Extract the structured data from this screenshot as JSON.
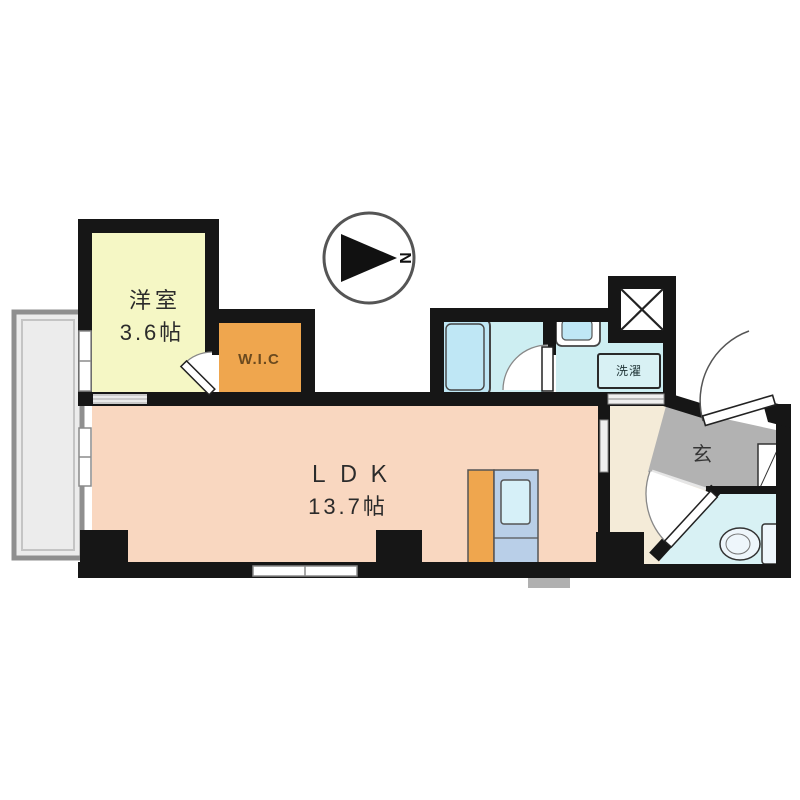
{
  "plan": {
    "type": "floor-plan",
    "compass": {
      "north_label": "N",
      "direction": "right"
    },
    "rooms": {
      "bedroom": {
        "name": "洋室",
        "size": "3.6帖"
      },
      "wic": {
        "label": "W.I.C"
      },
      "ldk": {
        "name": "ＬＤＫ",
        "size": "13.7帖"
      },
      "laundry": {
        "label": "洗濯"
      },
      "entrance": {
        "label": "玄"
      }
    }
  },
  "colors": {
    "wall": "#161616",
    "bedroom": "#f5f7c5",
    "wic": "#efa64e",
    "ldk": "#f9d7c0",
    "wet_room": "#cdeef2",
    "bathtub": "#bfe7f5",
    "hallway": "#f4ebd8",
    "entrance_floor": "#b2b2b2",
    "toilet_room": "#d8f1f4",
    "balcony": "#ececec",
    "kitchen_counter": "#efa64e",
    "kitchen_unit": "#b9cfe8",
    "sink": "#d6f0f8",
    "fixture": "#eef6fb"
  }
}
